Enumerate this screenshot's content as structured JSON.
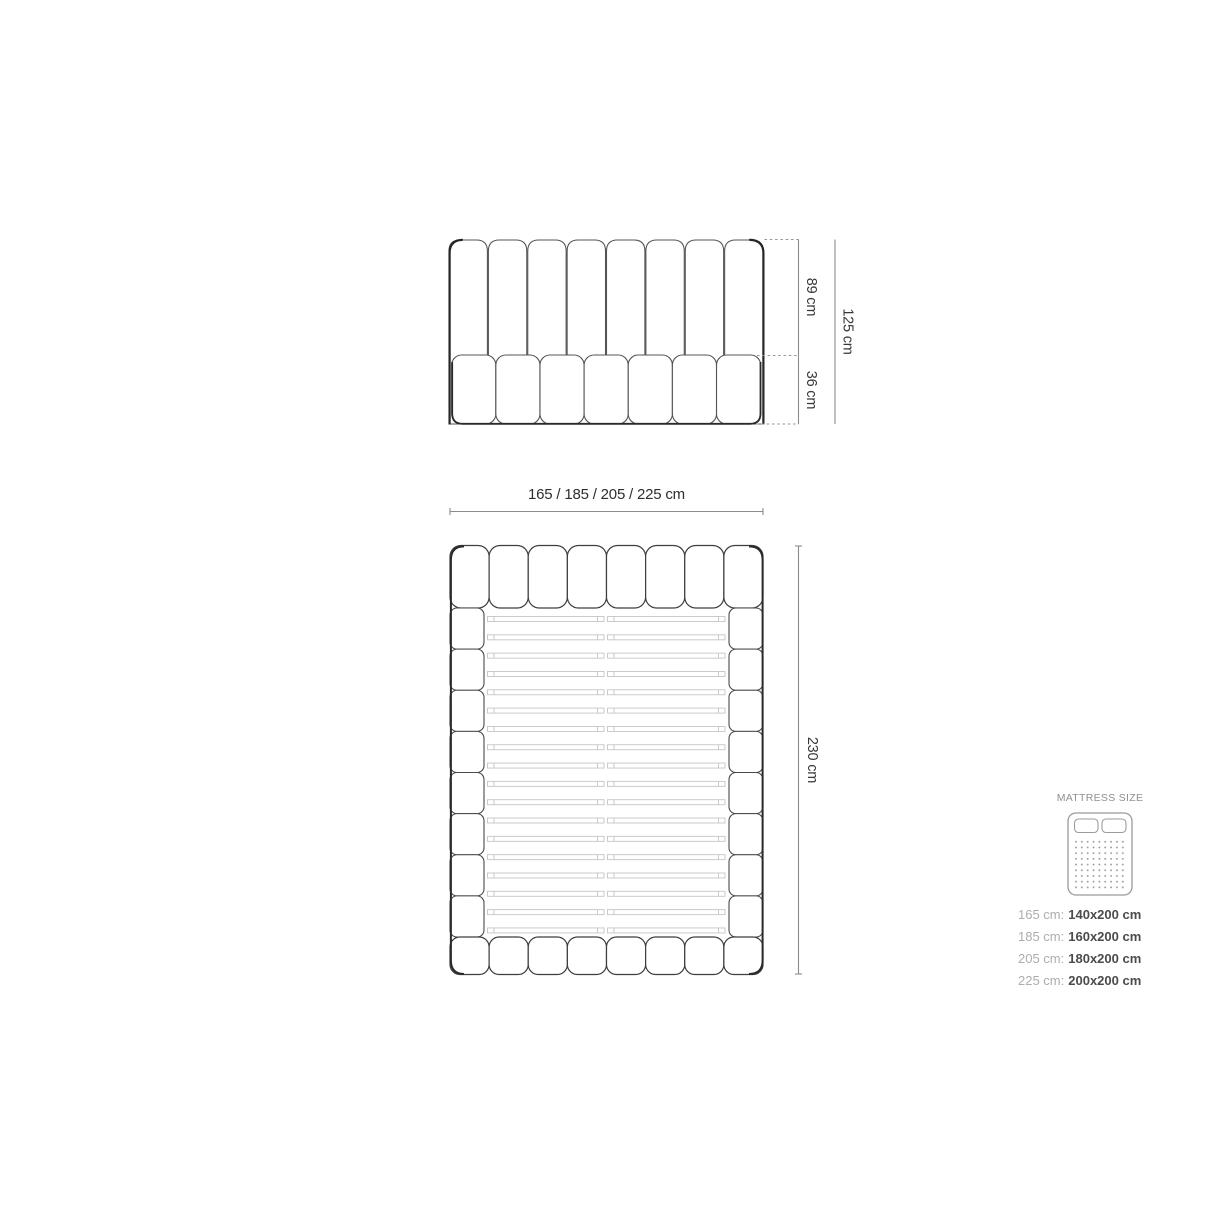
{
  "front_view": {
    "label_height_upper": "89 cm",
    "label_height_lower": "36 cm",
    "label_height_total": "125 cm"
  },
  "top_view": {
    "label_width": "165 / 185 / 205 / 225 cm",
    "label_depth": "230 cm"
  },
  "mattress_panel": {
    "title": "MATTRESS SIZE",
    "rows": [
      {
        "size": "165 cm:",
        "value": "140x200 cm"
      },
      {
        "size": "185 cm:",
        "value": "160x200 cm"
      },
      {
        "size": "205 cm:",
        "value": "180x200 cm"
      },
      {
        "size": "225 cm:",
        "value": "200x200 cm"
      }
    ]
  },
  "structure": {
    "headboard_channels": 8,
    "front_base_cushions": 7,
    "top_row_cushions": 8,
    "bottom_row_cushions": 8,
    "side_rail_segments_per_side": 8,
    "slat_count": 18,
    "slats_split_in_middle": true
  },
  "colors": {
    "background": "#ffffff",
    "outline_dark": "#2a2a2a",
    "outline_medium": "#555555",
    "slat_gray": "#c5c5c5",
    "dimension_line": "#8c8c8c",
    "dashed_line": "#969696",
    "label_text": "#383838",
    "panel_title_text": "#8f8f8f",
    "size_label_text": "#adadad",
    "size_value_text": "#4b4b4b",
    "icon_gray": "#9b9b9b"
  }
}
